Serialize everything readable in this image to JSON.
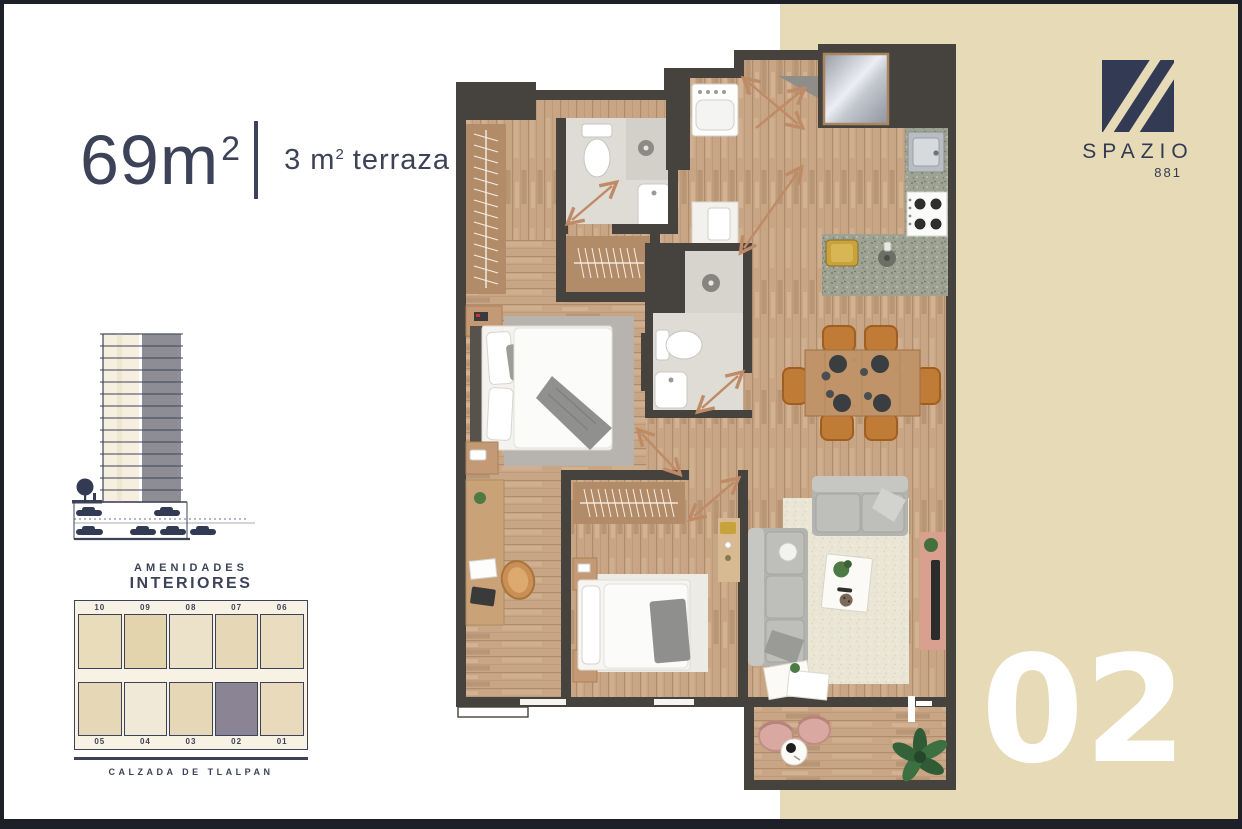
{
  "page": {
    "background": "#ffffff",
    "frame_color": "#1d2026",
    "accent_navy": "#3c4258",
    "panel_beige": "#e7dab7",
    "unit_number_color": "#ffffff"
  },
  "header": {
    "area_main": "69m",
    "area_sup": "2",
    "terrace_pre": "3 m",
    "terrace_sup": "2",
    "terrace_word": "terraza"
  },
  "brand": {
    "name": "SPAZIO",
    "number": "881",
    "logo_color": "#333a53"
  },
  "unit_badge": {
    "label": "02"
  },
  "key_plan": {
    "title_line1": "AMENIDADES",
    "title_line2": "INTERIORES",
    "street": "CALZADA DE TLALPAN",
    "top_units": [
      "10",
      "09",
      "08",
      "07",
      "06"
    ],
    "bottom_units": [
      "05",
      "04",
      "03",
      "02",
      "01"
    ],
    "highlighted_unit": "02",
    "highlight_color": "#8a8494",
    "unit_fills_top": [
      "#e9dcbb",
      "#e3d4ae",
      "#ece2c9",
      "#e6d8b6",
      "#e9dcbf"
    ],
    "unit_fills_bottom": [
      "#e6d8b6",
      "#f0e9d7",
      "#e6d8b6",
      "#8a8494",
      "#e8daba"
    ]
  },
  "elevation": {
    "floors": 14,
    "body_color": "#f6efdf",
    "highlight_stack_color": "#8e8d93",
    "line_color": "#3c4258"
  },
  "floor_plan": {
    "wall_color": "#46423d",
    "wood_color": "#c7a585",
    "bath_floor_color": "#dedcd5",
    "counter_granite_color": "#9da293",
    "living_rug_color": "#eae6d5",
    "master_rug_color": "#b7b3ae",
    "door_arrow_color": "#bf8a66",
    "elements": [
      "walk-in-closet",
      "bathroom-1",
      "linen-closet",
      "laundry-washer",
      "water-heater",
      "entry-mirror",
      "kitchen-sink",
      "stove",
      "kitchen-peninsula",
      "gold-tray",
      "dining-table",
      "dining-chairs",
      "bathroom-2",
      "master-bed",
      "master-rug",
      "nightstands",
      "desk",
      "desk-chair",
      "bedroom2-closet",
      "bedroom2-bed",
      "sofa-long",
      "sofa-short",
      "living-rug",
      "coffee-tray",
      "tv-console",
      "terrace-chairs",
      "terrace-table",
      "terrace-plant"
    ]
  }
}
